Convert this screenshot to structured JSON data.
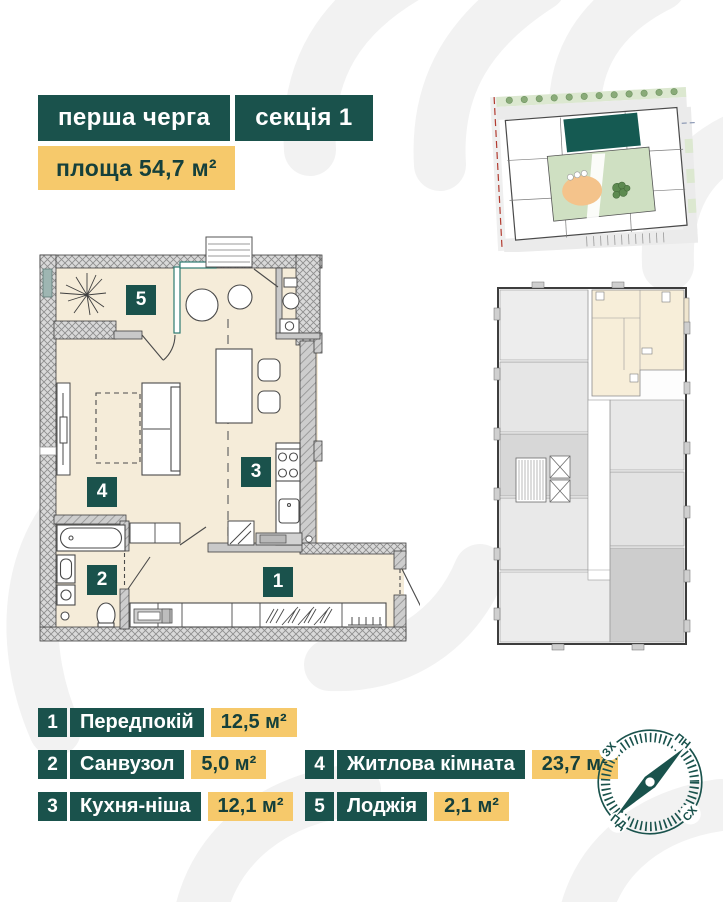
{
  "colors": {
    "teal": "#1a524c",
    "yellow": "#f6c96b",
    "floor": "#f5ecd9",
    "dark_text": "#15403b"
  },
  "header": {
    "phase_badge": "перша черга",
    "section_badge": "секція 1",
    "area_badge": "площа 54,7 м²"
  },
  "legend": {
    "items": [
      {
        "number": "1",
        "label": "Передпокій",
        "area": "12,5 м²"
      },
      {
        "number": "2",
        "label": "Санвузол",
        "area": "5,0 м²"
      },
      {
        "number": "3",
        "label": "Кухня-ніша",
        "area": "12,1 м²"
      },
      {
        "number": "4",
        "label": "Житлова кімната",
        "area": "23,7 м²"
      },
      {
        "number": "5",
        "label": "Лоджія",
        "area": "2,1 м²"
      }
    ]
  },
  "compass": {
    "north": "ПН",
    "east": "СХ",
    "south": "ПД",
    "west": "ЗХ"
  }
}
